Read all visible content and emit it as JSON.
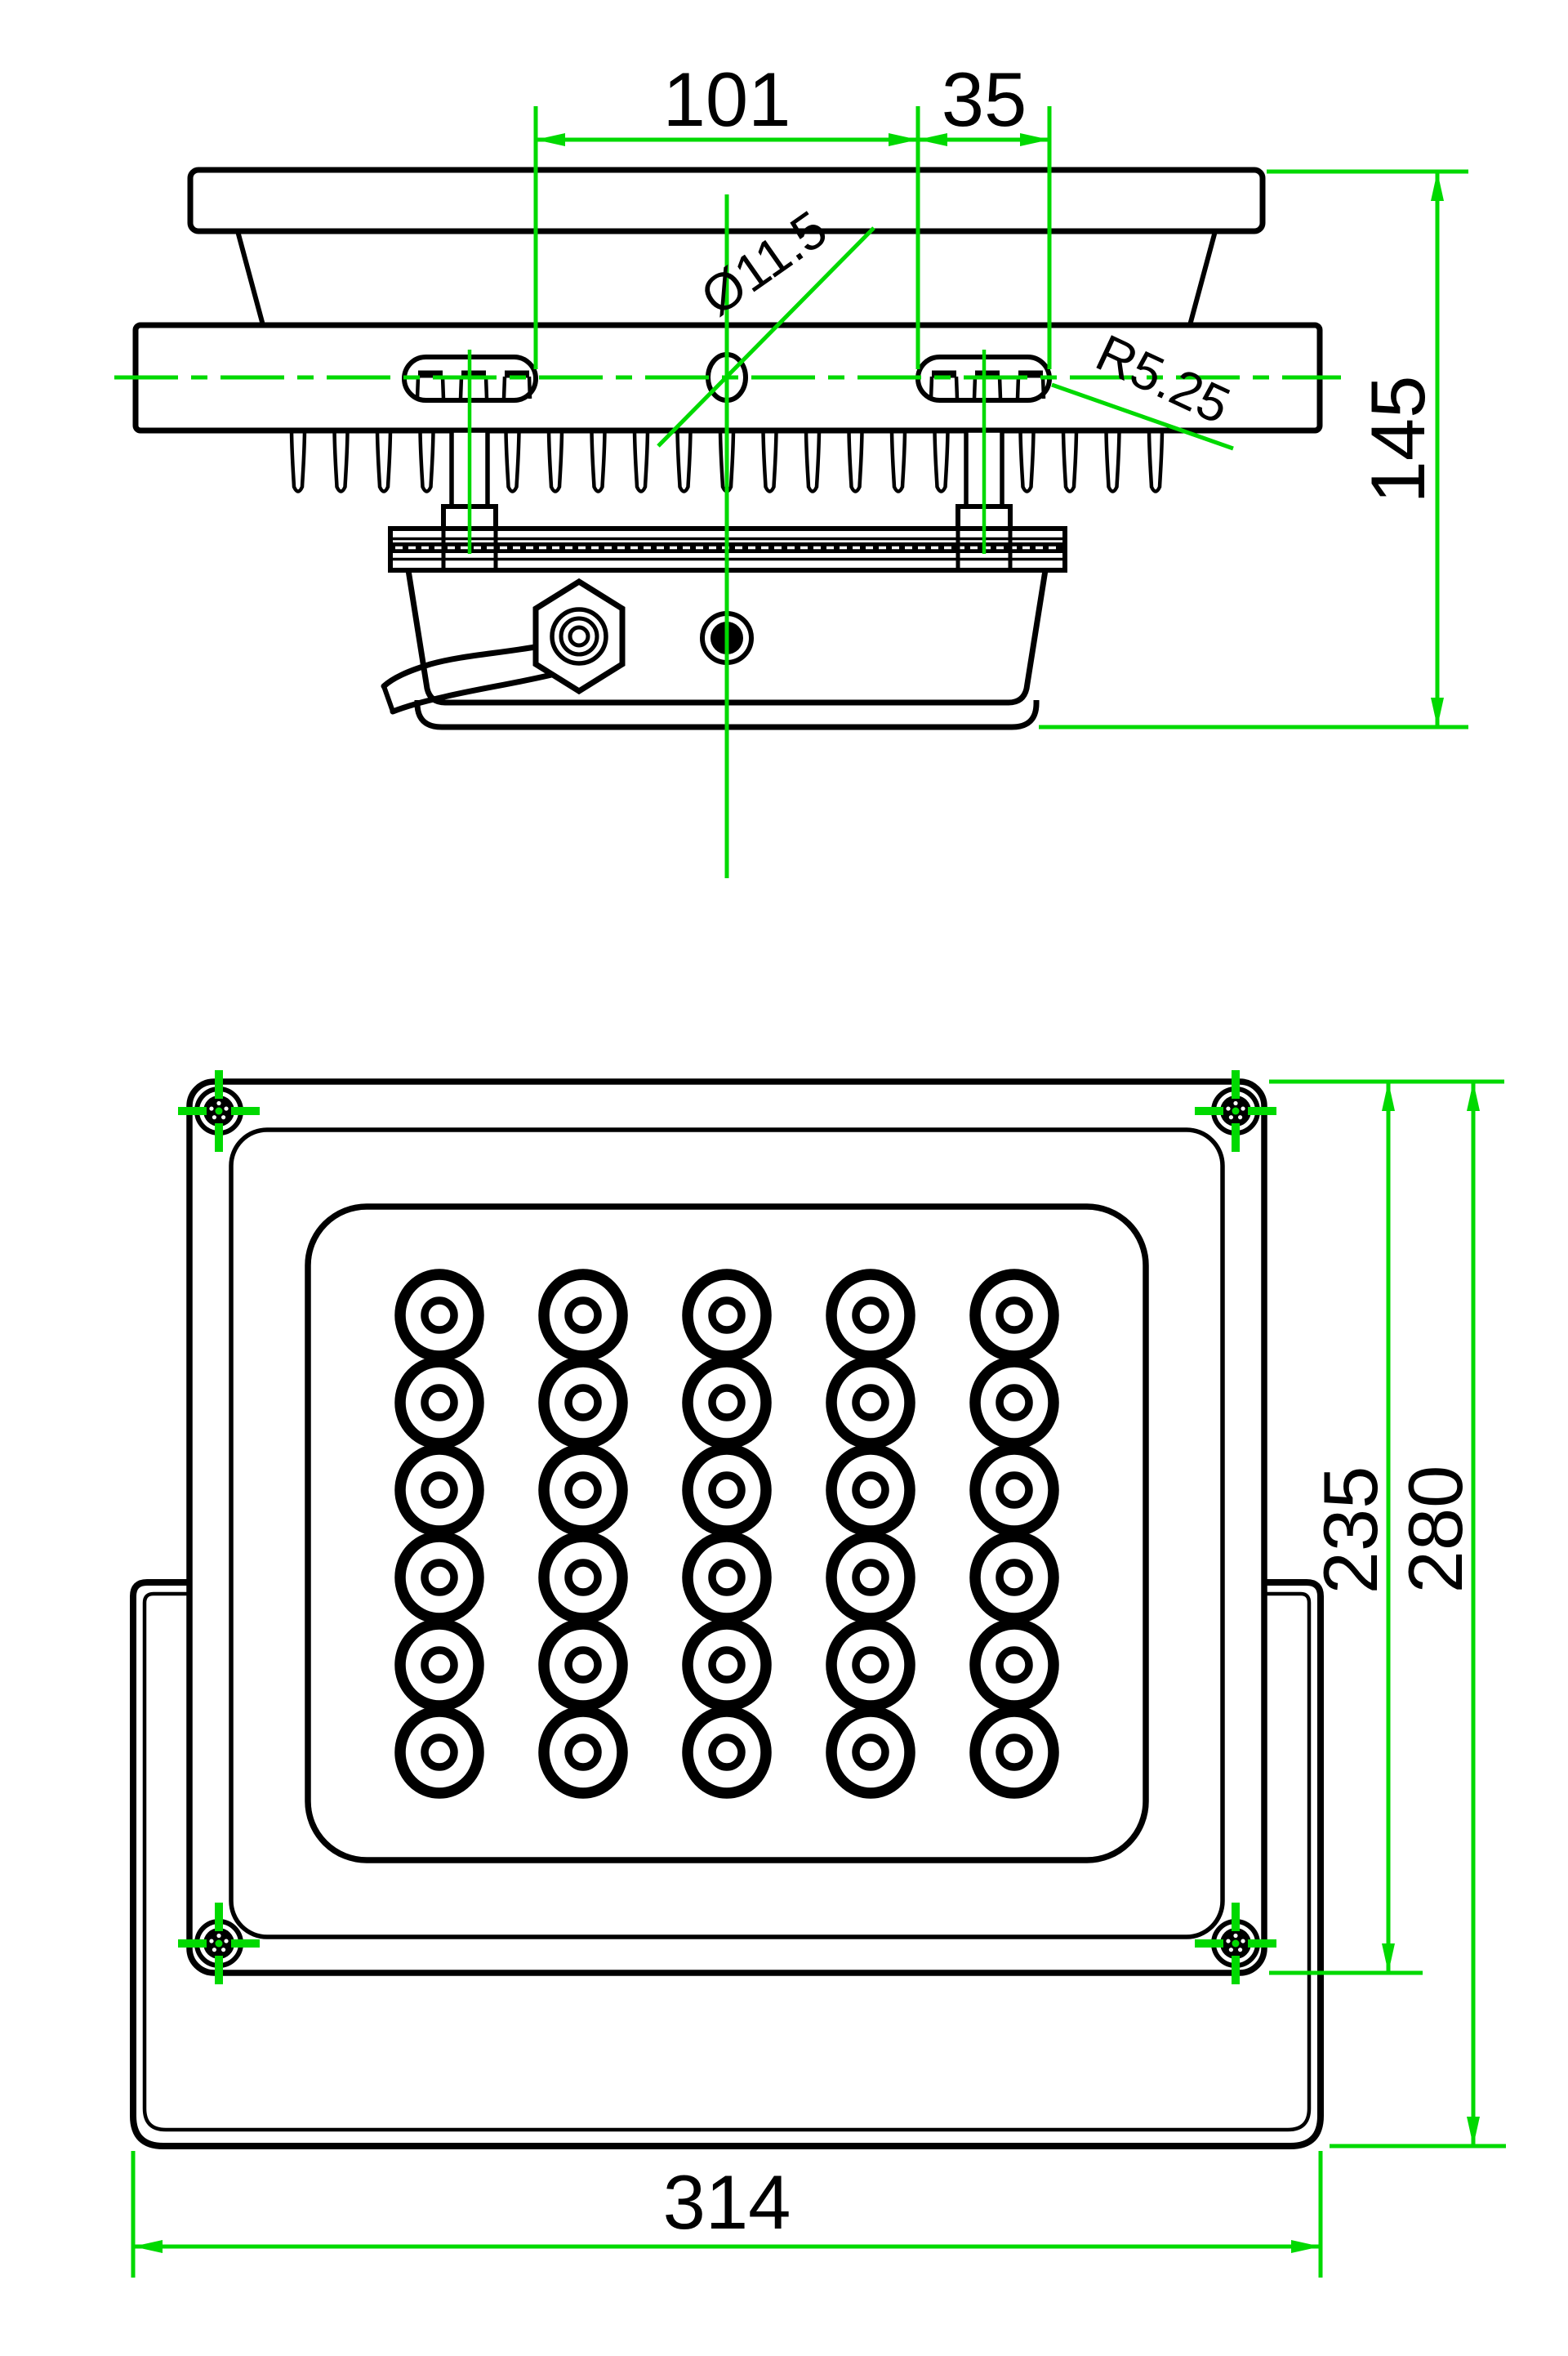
{
  "document": {
    "kind": "CAD technical drawing",
    "subject": "LED floodlight dimensional drawing - side section view and front view",
    "units": "mm",
    "background": "#ffffff"
  },
  "colors": {
    "outline": "#000000",
    "dimension": "#00d900",
    "label_text": "#000000"
  },
  "views": {
    "side": {
      "title": "side-view",
      "dims": {
        "slot_gap": "101",
        "slot_length": "35",
        "hole_diameter": "Ø11.5",
        "slot_end_radius": "R5.25",
        "overall_height": "145"
      },
      "fins": {
        "count": 19
      },
      "mounting_slots": {
        "count": 2,
        "x_starts": [
          495,
          1124
        ]
      },
      "screw_posts": {
        "count": 2,
        "centers": [
          575,
          1205
        ]
      }
    },
    "front": {
      "title": "front-view",
      "led_grid": {
        "columns": 5,
        "rows": 6,
        "total": 30,
        "col_centers": [
          538,
          714,
          890,
          1066,
          1242
        ],
        "row_centers": [
          1610,
          1717,
          1824,
          1931,
          2038,
          2145
        ]
      },
      "corner_screws": {
        "count": 4,
        "centers": [
          [
            268,
            1360
          ],
          [
            1513,
            1360
          ],
          [
            268,
            2379
          ],
          [
            1513,
            2379
          ]
        ]
      },
      "dims": {
        "head_height": "235",
        "overall_height": "280",
        "overall_width": "314"
      }
    }
  }
}
